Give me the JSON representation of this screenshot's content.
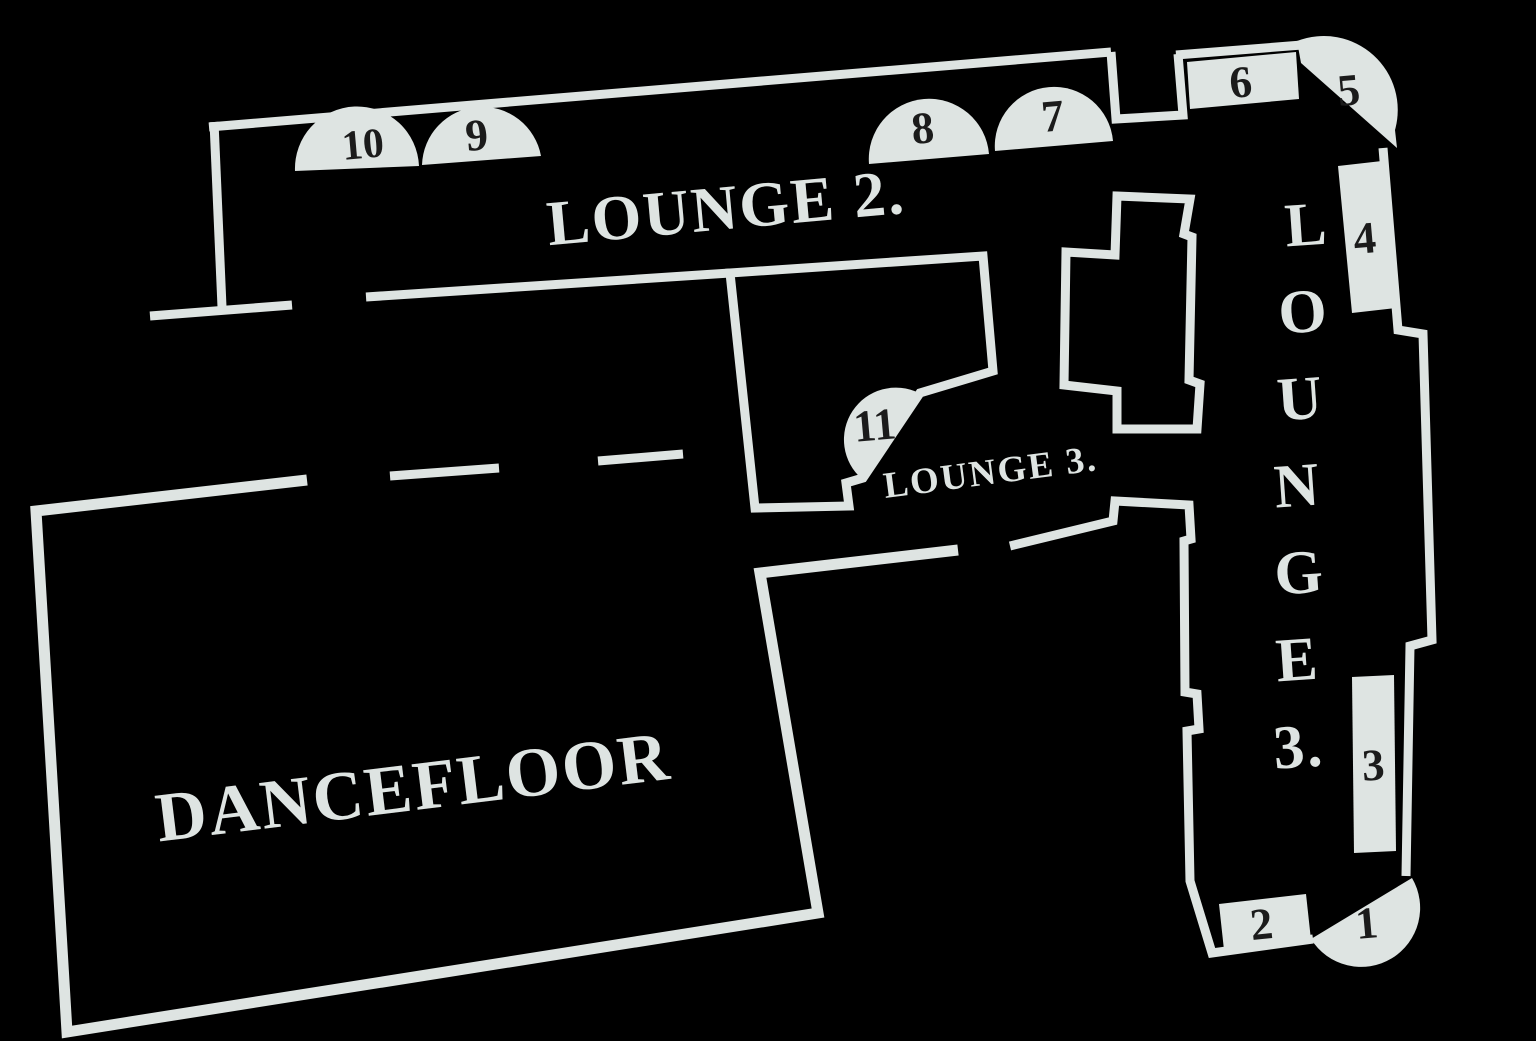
{
  "colors": {
    "background": "#000000",
    "line": "#dee4e2",
    "booth_fill": "#dee4e2",
    "number_text": "#1b1b1b"
  },
  "labels": {
    "lounge2": "LOUNGE 2.",
    "lounge3_inline": "LOUNGE 3.",
    "dancefloor": "DANCEFLOOR",
    "lounge3_vertical": [
      "L",
      "O",
      "U",
      "N",
      "G",
      "E",
      "3."
    ]
  },
  "booths": [
    {
      "number": "1",
      "shape": "half-circle"
    },
    {
      "number": "2",
      "shape": "rectangle"
    },
    {
      "number": "3",
      "shape": "rectangle"
    },
    {
      "number": "4",
      "shape": "rectangle"
    },
    {
      "number": "5",
      "shape": "rounded-corner"
    },
    {
      "number": "6",
      "shape": "rectangle"
    },
    {
      "number": "7",
      "shape": "half-circle"
    },
    {
      "number": "8",
      "shape": "half-circle"
    },
    {
      "number": "9",
      "shape": "half-circle"
    },
    {
      "number": "10",
      "shape": "half-circle"
    },
    {
      "number": "11",
      "shape": "half-circle"
    }
  ]
}
